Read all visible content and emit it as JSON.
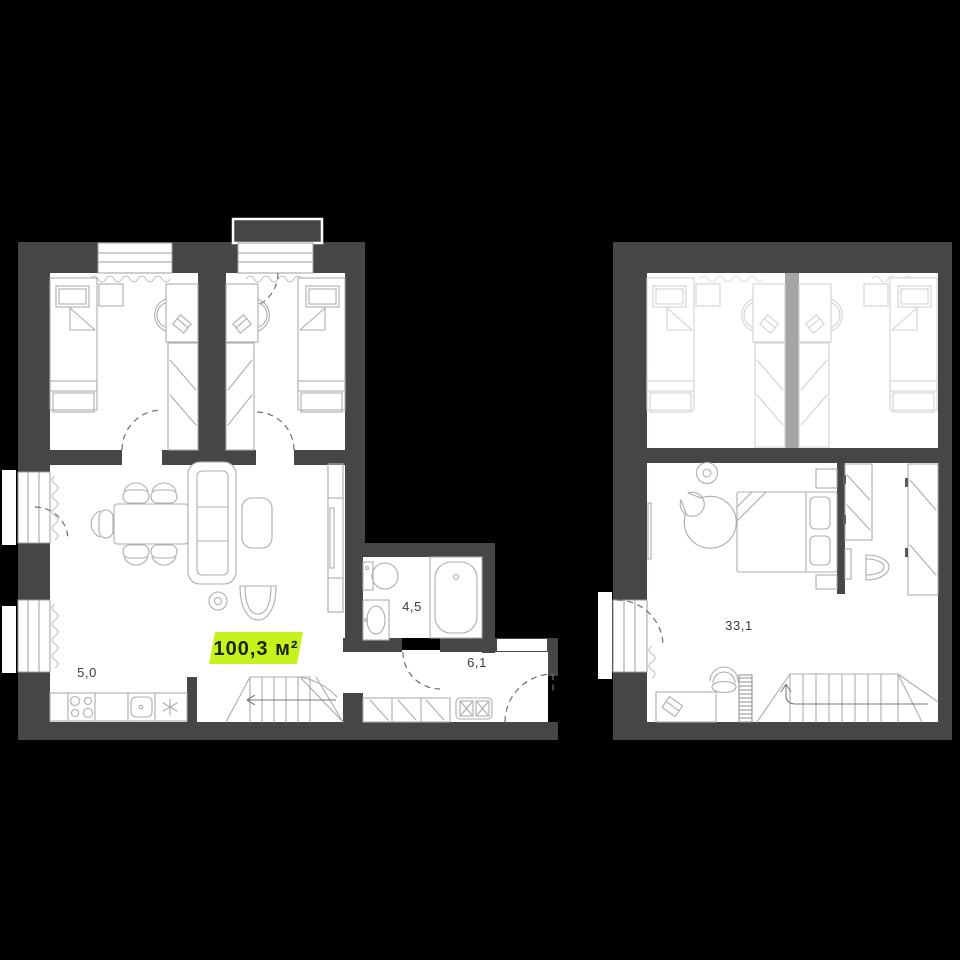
{
  "floor1": {
    "area_badge": "100,3 м²",
    "kitchen_label": "5,0",
    "bathroom_label": "4,5",
    "hall_label": "6,1"
  },
  "floor2": {
    "bedroom_label": "33,1"
  },
  "colors": {
    "background": "#000000",
    "wall": "#474645",
    "room_fill": "#ffffff",
    "furniture_line": "#adadad",
    "faded_line": "#d2d2d2",
    "door_arc": "#6f6f6f",
    "badge_bg": "#c6f31d",
    "badge_text": "#1e2406",
    "label_text": "#3c3c3c"
  }
}
